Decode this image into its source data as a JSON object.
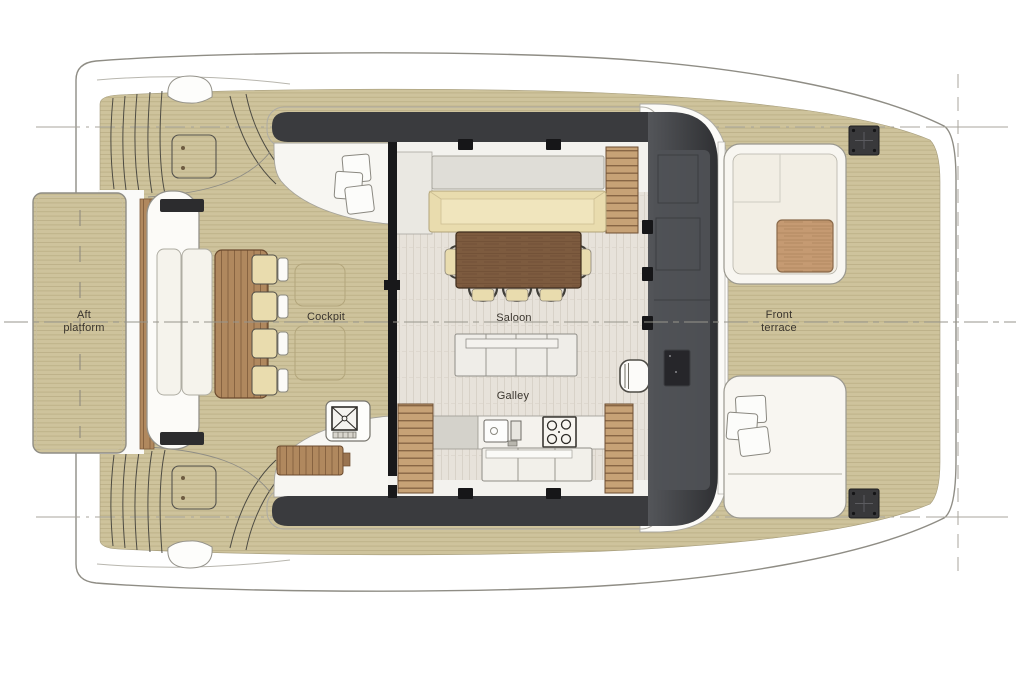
{
  "labels": {
    "aft_platform": [
      "Aft",
      "platform"
    ],
    "cockpit": "Cockpit",
    "saloon": "Saloon",
    "galley": "Galley",
    "front_terrace": [
      "Front",
      "terrace"
    ]
  },
  "colors": {
    "page_bg": "#ffffff",
    "hull_stroke": "#8f8d85",
    "construction_line": "#a8a69c",
    "teak": "#cec39c",
    "teak_line": "#b1a47a",
    "wood_mid": "#b0885e",
    "wood_mid_line": "#7d5a3a",
    "wood_step": "#c7a276",
    "wood_step_line": "#7d5c3c",
    "wood_table_front": "#c59a72",
    "walnut": "#7d5b3f",
    "floor": "#e7e2da",
    "floor_line": "#d8d2c8",
    "charcoal_dark": "#2f3033",
    "charcoal_light": "#54565a",
    "cream": "#e9dcae",
    "panel_white": "#f4f2ec",
    "label_text": "#3a352e"
  }
}
